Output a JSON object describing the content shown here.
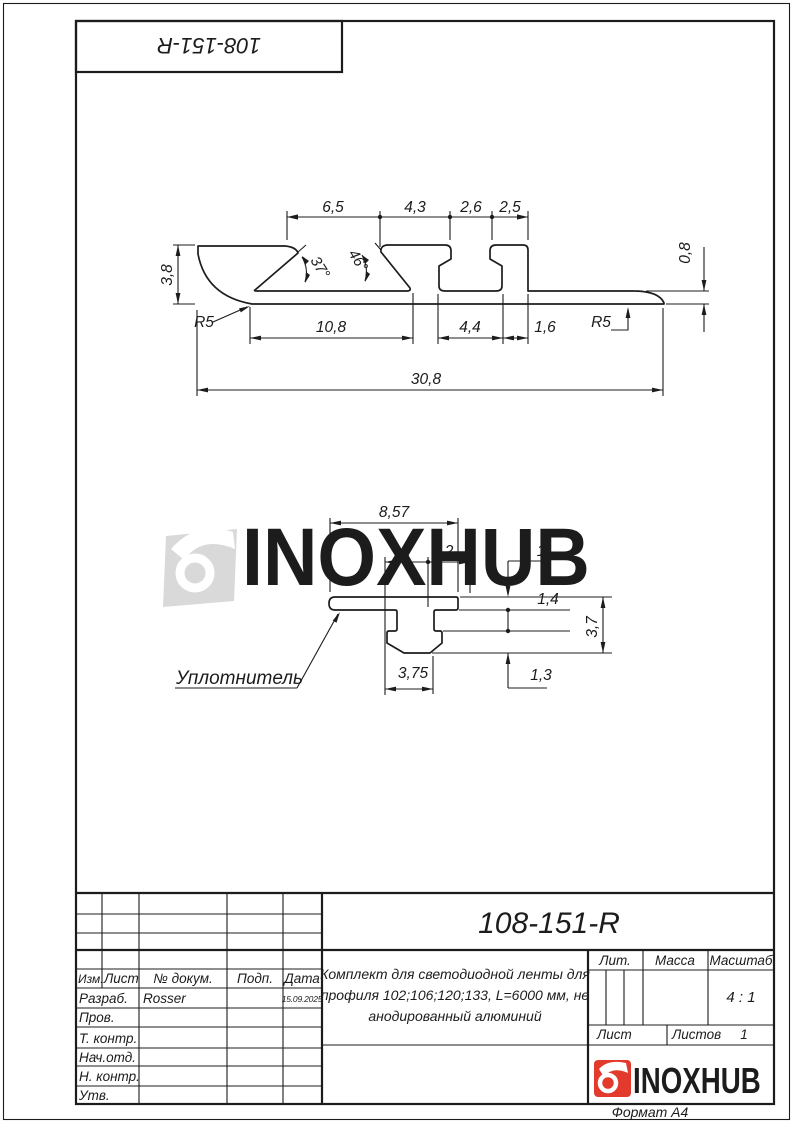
{
  "doc_number": "108-151-R",
  "watermark_text": "INOXHUB",
  "logo_text": "INOXHUB",
  "format_label": "Формат А4",
  "colors": {
    "line": "#1c1c1c",
    "accent_red": "#e23b2e",
    "watermark": "#d9d9d9",
    "logo_text": "#2f2f2f"
  },
  "main_view": {
    "dim_6_5": "6,5",
    "dim_4_3": "4,3",
    "dim_2_6": "2,6",
    "dim_2_5": "2,5",
    "dim_3_8": "3,8",
    "angle_37": "37°",
    "angle_46": "46°",
    "dim_0_8": "0,8",
    "r5_left": "R5",
    "r5_right": "R5",
    "dim_10_8": "10,8",
    "dim_4_4": "4,4",
    "dim_1_6": "1,6",
    "dim_30_8": "30,8"
  },
  "seal_view": {
    "label": "Уплотнитель",
    "dim_8_57": "8,57",
    "dim_2_left": "2",
    "dim_2_right": "2",
    "dim_1": "1",
    "dim_1_4": "1,4",
    "dim_3_7": "3,7",
    "dim_1_3": "1,3",
    "dim_3_75": "3,75"
  },
  "title_block": {
    "designation": "108-151-R",
    "description_line1": "Комплект для светодиодной ленты для",
    "description_line2": "профиля 102;106;120;133, L=6000 мм, не",
    "description_line3": "анодированный алюминий",
    "lit_label": "Лит.",
    "massa_label": "Масса",
    "masshtab_label": "Масштаб",
    "scale_value": "4 : 1",
    "list_label": "Лист",
    "listov_label": "Листов",
    "listov_value": "1",
    "col_izm": "Изм.",
    "col_list": "Лист",
    "col_ndok": "№ докум.",
    "col_podp": "Подп.",
    "col_data": "Дата",
    "row_razrab": "Разраб.",
    "razrab_name": "Rosser",
    "razrab_date": "15.09.2025",
    "row_prov": "Пров.",
    "row_tkontr": "Т. контр.",
    "row_nachotd": "Нач.отд.",
    "row_nkontr": "Н. контр.",
    "row_utv": "Утв."
  }
}
